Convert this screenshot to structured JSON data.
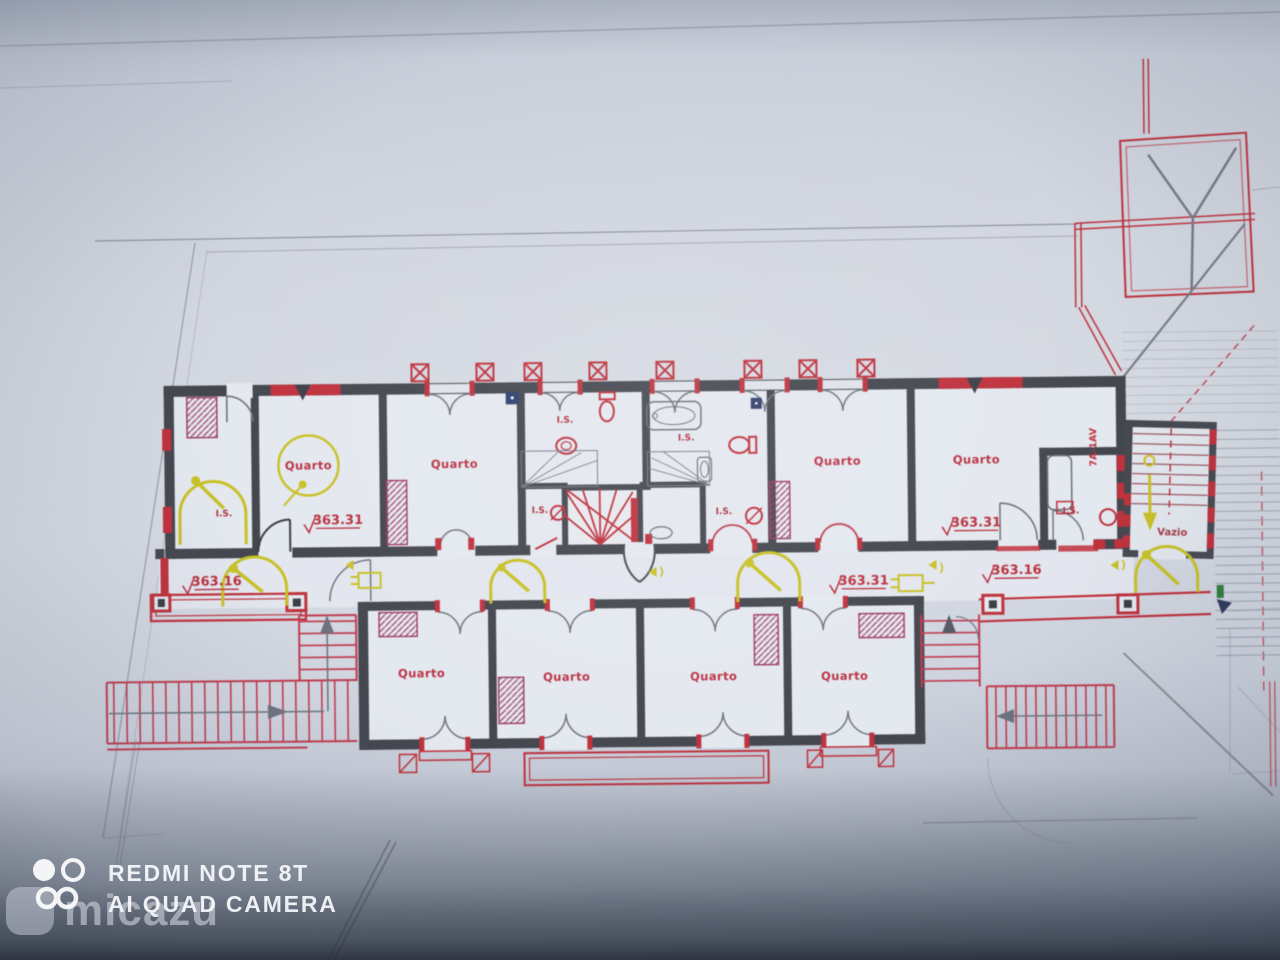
{
  "watermarks": {
    "camera_line1": "REDMI NOTE 8T",
    "camera_line2": "AI QUAD CAMERA",
    "brand": "micazu"
  },
  "plan": {
    "upper_rooms": [
      {
        "label": "Quarto"
      },
      {
        "label": "Quarto"
      },
      {
        "label": "Quarto"
      },
      {
        "label": "Quarto"
      }
    ],
    "lower_rooms": [
      {
        "label": "Quarto"
      },
      {
        "label": "Quarto"
      },
      {
        "label": "Quarto"
      },
      {
        "label": "Quarto"
      }
    ],
    "sanitary_labels": [
      {
        "text": "I.S."
      },
      {
        "text": "I.S."
      },
      {
        "text": "I.S."
      },
      {
        "text": "I.S."
      },
      {
        "text": "I.S."
      },
      {
        "text": "I.S."
      }
    ],
    "elevation_marks": [
      {
        "text": "363.31"
      },
      {
        "text": "363.16"
      },
      {
        "text": "363.31"
      },
      {
        "text": "363.31"
      },
      {
        "text": "363.16"
      }
    ],
    "void_room_label": "Vazio",
    "wall_tag": "7A-1AV",
    "colors": {
      "wall": "#45474f",
      "red": "#c5303c",
      "magenta": "#a23a6a",
      "yellow": "#c9c11f",
      "label": "#bf3044"
    }
  }
}
